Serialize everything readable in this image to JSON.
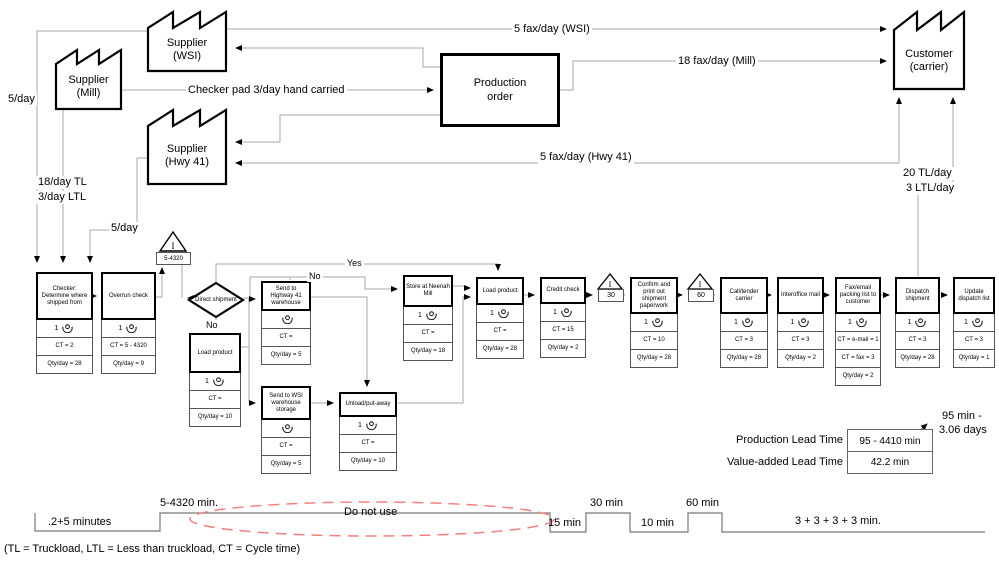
{
  "entities": {
    "supplier_wsi": {
      "line1": "Supplier",
      "line2": "(WSI)"
    },
    "supplier_mill": {
      "line1": "Supplier",
      "line2": "(Mill)"
    },
    "supplier_hwy41": {
      "line1": "Supplier",
      "line2": "(Hwy 41)"
    },
    "customer": {
      "line1": "Customer",
      "line2": "(carrier)"
    },
    "production_order": {
      "line1": "Production",
      "line2": "order"
    }
  },
  "flow_labels": {
    "fax_wsi": "5 fax/day (WSI)",
    "fax_mill": "18 fax/day (Mill)",
    "fax_hwy41": "5 fax/day (Hwy 41)",
    "checker_pad": "Checker pad 3/day hand carried",
    "wsi_rate": "5/day",
    "mill_rate_tl": "18/day TL",
    "mill_rate_ltl": "3/day LTL",
    "hwy41_rate": "5/day",
    "customer_rate_tl": "20 TL/day",
    "customer_rate_ltl": "3 LTL/day",
    "yes": "Yes",
    "no_branch": "No",
    "no_down": "No"
  },
  "decision": {
    "label": "Direct shipment"
  },
  "inventory_triangles": [
    {
      "symbol": "I",
      "value": "5-4320"
    },
    {
      "symbol": "I",
      "value": "30"
    },
    {
      "symbol": "I",
      "value": "60"
    }
  ],
  "processes": [
    {
      "title": "Checker: Determine where shipped from",
      "op": "1",
      "ct": "CT = 2",
      "qty": "Qty/day = 28"
    },
    {
      "title": "Overrun check",
      "op": "1",
      "ct": "CT = 5 - 4320",
      "qty": "Qty/day = 9"
    },
    {
      "title": "Load product",
      "op": "1",
      "ct": "CT =",
      "qty": "Qty/day = 10"
    },
    {
      "title": "Send to Highway 41 warehouse",
      "op": "",
      "ct": "CT =",
      "qty": "Qty/day = 5"
    },
    {
      "title": "Send to WSI warehouse storage",
      "op": "",
      "ct": "CT =",
      "qty": "Qty/day = 5"
    },
    {
      "title": "Unload/put-away",
      "op": "1",
      "ct": "CT =",
      "qty": "Qty/day = 10"
    },
    {
      "title": "Store at Neenah Mill",
      "op": "1",
      "ct": "CT =",
      "qty": "Qty/day = 18"
    },
    {
      "title": "Load product",
      "op": "1",
      "ct": "CT =",
      "qty": "Qty/day = 28"
    },
    {
      "title": "Credit check",
      "op": "1",
      "ct": "CT = 15",
      "qty": "Qty/day = 2"
    },
    {
      "title": "Confirm and print out shipment paperwork",
      "op": "1",
      "ct": "CT = 10",
      "qty": "Qty/day = 28"
    },
    {
      "title": "Call/tender carrier",
      "op": "1",
      "ct": "CT = 3",
      "qty": "Qty/day = 28"
    },
    {
      "title": "Interoffice mail",
      "op": "1",
      "ct": "CT = 3",
      "qty": "Qty/day = 2"
    },
    {
      "title": "Fax/email packing list to customer",
      "op": "1",
      "ct": "CT = e-mail = 1",
      "ct2": "CT = fax = 3",
      "qty": "Qty/day = 2"
    },
    {
      "title": "Dispatch shipment",
      "op": "1",
      "ct": "CT = 3",
      "qty": "Qty/day = 28"
    },
    {
      "title": "Update dispatch list",
      "op": "1",
      "ct": "CT = 3",
      "qty": "Qty/day = 1"
    }
  ],
  "leadtime": {
    "production_label": "Production Lead Time",
    "production_value": "95 - 4410 min",
    "value_added_label": "Value-added Lead Time",
    "value_added_value": "42.2 min",
    "range_line1": "95 min -",
    "range_line2": "3.06 days"
  },
  "timeline": {
    "segments": [
      ".2+5 minutes",
      "5-4320 min.",
      "15 min",
      "30 min",
      "10 min",
      "60 min",
      "3 + 3 + 3 + 3 min."
    ],
    "do_not_use": "Do not use"
  },
  "footnote": "(TL = Truckload, LTL = Less than truckload, CT = Cycle time)"
}
